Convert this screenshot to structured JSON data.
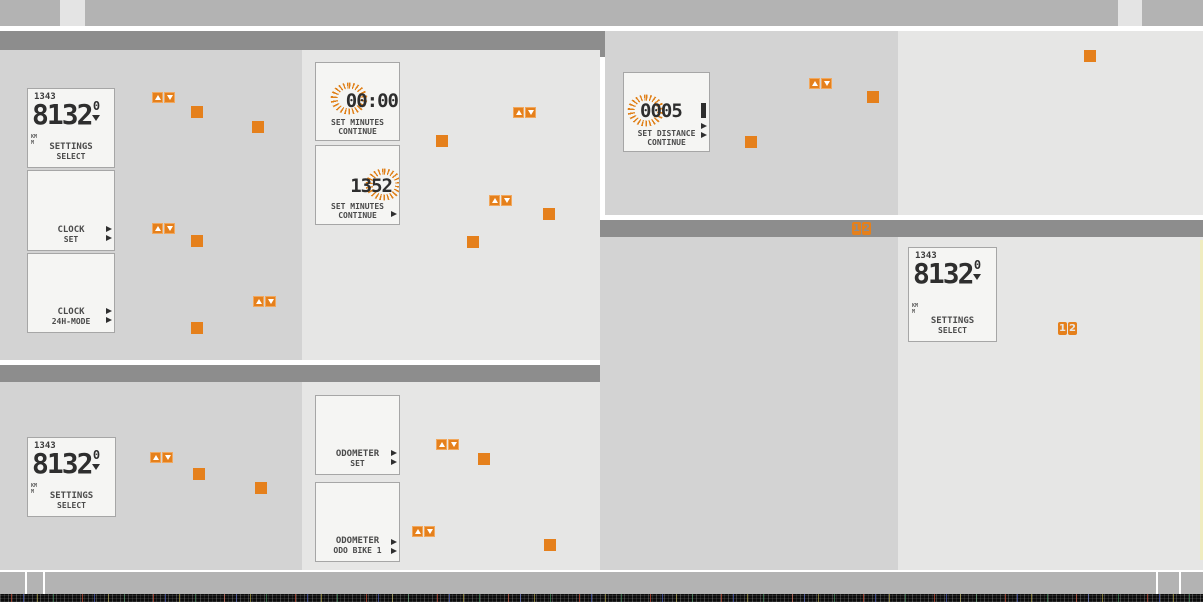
{
  "colors": {
    "orange": "#e5801c",
    "header_bar": "#8d8d8d",
    "panel_dark": "#d3d3d3",
    "panel_light": "#e6e6e5",
    "topbar": "#b3b3b3"
  },
  "badges": {
    "one": "1",
    "two": "2"
  },
  "screens": {
    "settings": {
      "time": "1343",
      "value": "8132",
      "sup": "0",
      "unit1": "KM",
      "unit2": "M",
      "label1": "SETTINGS",
      "label2": "SELECT"
    },
    "clock_set": {
      "label1": "CLOCK",
      "label2": "SET"
    },
    "clock_mode": {
      "label1": "CLOCK",
      "label2": "24H-MODE"
    },
    "set_minutes_initial": {
      "value": "00:00",
      "label1": "SET MINUTES",
      "label2": "CONTINUE"
    },
    "set_minutes_adjust": {
      "value": "1352",
      "label1": "SET MINUTES",
      "label2": "CONTINUE"
    },
    "set_distance": {
      "value": "0005",
      "label1": "SET DISTANCE",
      "label2": "CONTINUE"
    },
    "odometer_set": {
      "label1": "ODOMETER",
      "label2": "SET"
    },
    "odometer_bike": {
      "label1": "ODOMETER",
      "label2": "ODO BIKE 1"
    }
  }
}
